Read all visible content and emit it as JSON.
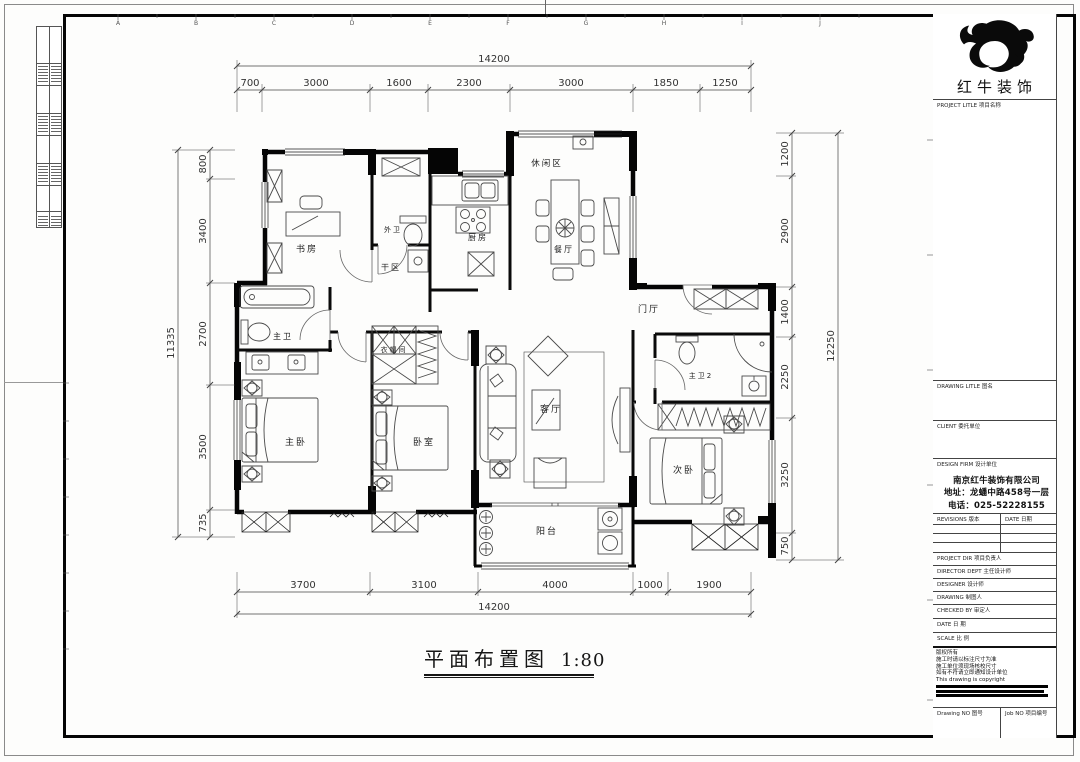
{
  "sheet": {
    "grid_letters": [
      "A",
      "B",
      "C",
      "D",
      "E",
      "F",
      "G",
      "H",
      "I",
      "J"
    ],
    "title": "平面布置图",
    "scale": "1:80"
  },
  "logo": {
    "company": "红牛装饰"
  },
  "title_block": {
    "project_label": "PROJECT LITLE  项目名称",
    "drawing_label": "DRAWING LITLE  图名",
    "client_label": "CLIENT  委托单位",
    "design_firm_label": "DESIGN FIRM  设计单位",
    "company_name": "南京红牛装饰有限公司",
    "company_address": "地址：龙蟠中路458号一层",
    "company_phone": "电话：025-52228155",
    "revisions_label": "REVISIONS  版本",
    "date_col_label": "DATE  日期",
    "project_dir_label": "PROJECT DIR  项目负责人",
    "director_label": "DIRECTOR DEPT  主任设计师",
    "designer_label": "DESIGNER  设计师",
    "drawing_by_label": "DRAWING  制图人",
    "checked_label": "CHECKED BY  审定人",
    "date_label": "DATE   日 期",
    "scale_label": "SCALE   比 例",
    "notes": [
      "版权所有",
      "施工时请以标注尺寸为准",
      "施工单位须现场核校尺寸",
      "如有不符请立即通知设计单位",
      "This drawing is copyright"
    ],
    "drawing_no_label": "Drawing NO  图号",
    "job_no_label": "Job NO  项目编号"
  },
  "plan": {
    "rooms": [
      {
        "name": "书房"
      },
      {
        "name": "外卫"
      },
      {
        "name": "干区"
      },
      {
        "name": "厨房"
      },
      {
        "name": "休闲区"
      },
      {
        "name": "餐厅"
      },
      {
        "name": "门厅"
      },
      {
        "name": "主卫"
      },
      {
        "name": "衣帽间"
      },
      {
        "name": "主卧"
      },
      {
        "name": "卧室"
      },
      {
        "name": "客厅"
      },
      {
        "name": "主卫2"
      },
      {
        "name": "次卧"
      },
      {
        "name": "阳台"
      }
    ],
    "dims": {
      "top": {
        "total": "14200",
        "segments": [
          "700",
          "3000",
          "1600",
          "2300",
          "3000",
          "1850",
          "1250"
        ]
      },
      "bottom": {
        "total": "14200",
        "segments": [
          "3700",
          "3100",
          "4000",
          "1000",
          "1900"
        ]
      },
      "left": {
        "total": "11335",
        "segments": [
          "800",
          "3400",
          "2700",
          "3500",
          "735"
        ]
      },
      "right": {
        "total": "12250",
        "segments": [
          "1200",
          "2900",
          "1400",
          "2250",
          "3250",
          "750"
        ]
      }
    }
  }
}
